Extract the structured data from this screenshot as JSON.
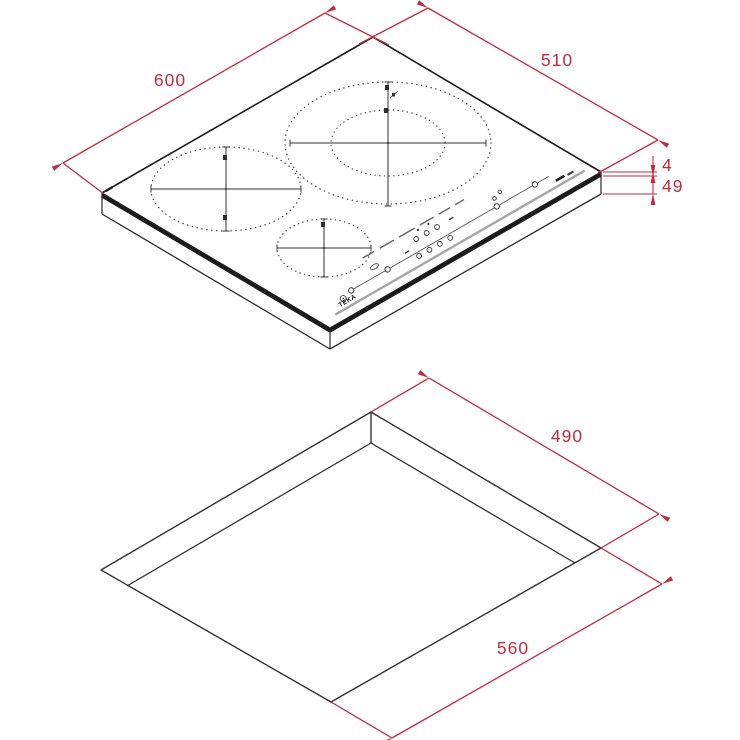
{
  "drawing": {
    "accent_color": "#C42A3E",
    "line_color": "#2b2b2b",
    "hob_view": {
      "brand_label": "TEKA",
      "width_mm": "600",
      "depth_mm": "510",
      "glass_thickness_mm": "4",
      "height_mm": "49",
      "zones": [
        "left-large-zone",
        "back-right-dual-zone",
        "front-small-zone"
      ]
    },
    "cutout_view": {
      "cutout_depth_mm": "490",
      "cutout_width_mm": "560"
    }
  }
}
